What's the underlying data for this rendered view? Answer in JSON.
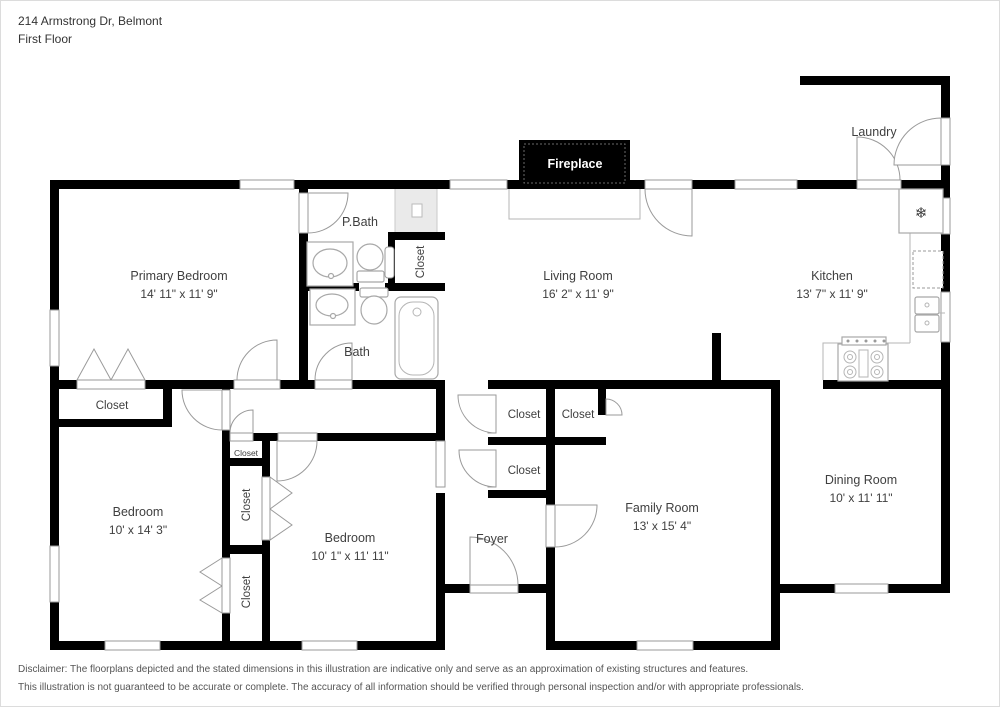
{
  "header": {
    "address": "214 Armstrong Dr, Belmont",
    "floor_label": "First Floor"
  },
  "fireplace": {
    "label": "Fireplace"
  },
  "rooms": {
    "laundry": {
      "label": "Laundry"
    },
    "primary_bedroom": {
      "label": "Primary Bedroom",
      "dims": "14' 11\" x 11' 9\""
    },
    "p_bath": {
      "label": "P.Bath"
    },
    "bath": {
      "label": "Bath"
    },
    "living_room": {
      "label": "Living Room",
      "dims": "16' 2\" x 11' 9\""
    },
    "kitchen": {
      "label": "Kitchen",
      "dims": "13' 7\" x 11' 9\""
    },
    "dining_room": {
      "label": "Dining Room",
      "dims": "10' x 11' 11\""
    },
    "family_room": {
      "label": "Family Room",
      "dims": "13' x 15' 4\""
    },
    "foyer": {
      "label": "Foyer"
    },
    "bedroom_left": {
      "label": "Bedroom",
      "dims": "10' x 14' 3\""
    },
    "bedroom_middle": {
      "label": "Bedroom",
      "dims": "10' 1\" x 11' 11\""
    }
  },
  "closets": {
    "primary_closet": {
      "label": "Closet"
    },
    "bath_closet": {
      "label": "Closet"
    },
    "bedroom_closet_small": {
      "label": "Closet"
    },
    "bedroom_closet_upper": {
      "label": "Closet"
    },
    "bedroom_closet_lower": {
      "label": "Closet"
    },
    "hall_closet_1": {
      "label": "Closet"
    },
    "hall_closet_2": {
      "label": "Closet"
    },
    "hall_closet_3": {
      "label": "Closet"
    }
  },
  "icons": {
    "refrigerator": "❄"
  },
  "disclaimer": {
    "line1": "Disclaimer: The floorplans depicted and the stated dimensions in this illustration are indicative only and serve as an approximation of existing structures and features.",
    "line2": "This illustration is not guaranteed to be accurate or complete. The accuracy of all information should be verified through personal inspection and/or with appropriate professionals."
  },
  "colors": {
    "wall": "#000000",
    "door_stroke": "#9a9a9a",
    "fixture_stroke": "#a8a8a8",
    "fireplace_bg": "#000000",
    "fireplace_text": "#ffffff",
    "text": "#3f3f3f"
  }
}
